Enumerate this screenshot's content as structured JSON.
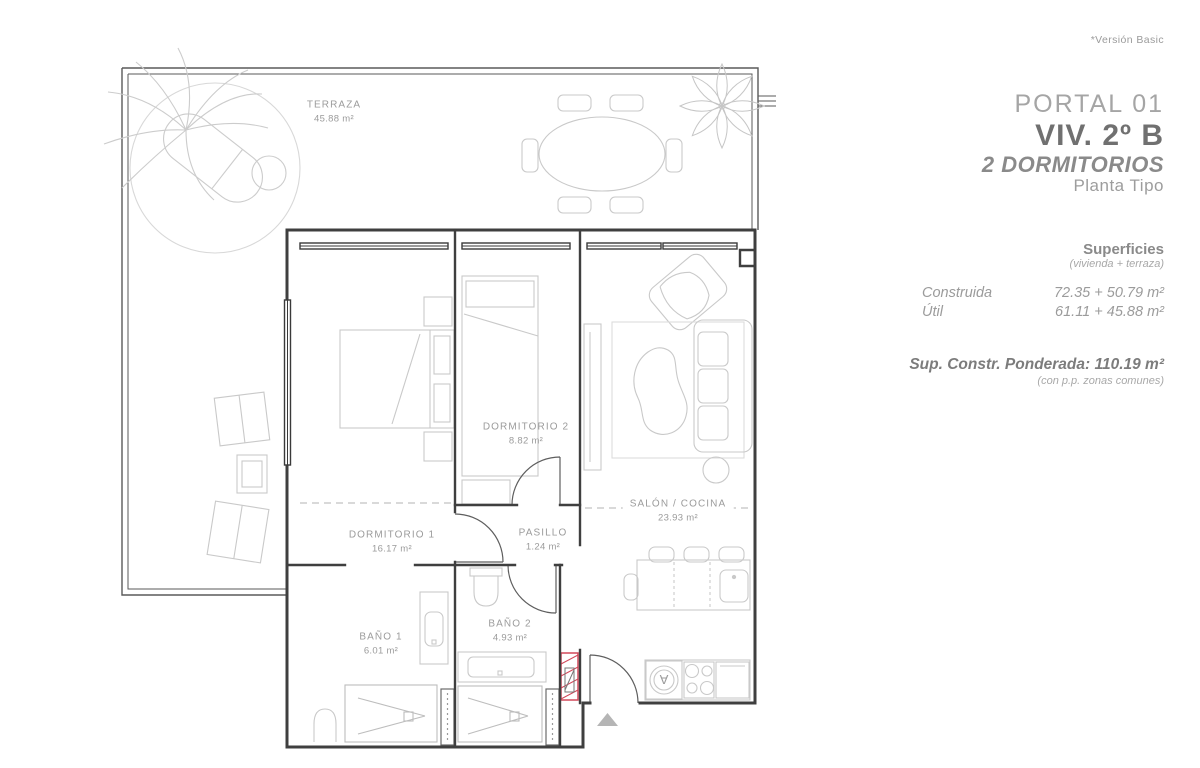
{
  "version_note": "*Versión Basic",
  "header": {
    "portal": "PORTAL 01",
    "unit": "VIV. 2º B",
    "bedrooms": "2 DORMITORIOS",
    "plan_type": "Planta Tipo"
  },
  "surfaces": {
    "title": "Superficies",
    "subtitle": "(vivienda + terraza)",
    "rows": [
      {
        "label": "Construida",
        "value": "72.35 + 50.79 m²"
      },
      {
        "label": "Útil",
        "value": "61.11 + 45.88 m²"
      }
    ],
    "weighted": "Sup. Constr. Ponderada: 110.19 m²",
    "weighted_note": "(con p.p. zonas comunes)"
  },
  "rooms": [
    {
      "name": "TERRAZA",
      "area": "45.88 m²"
    },
    {
      "name": "DORMITORIO 1",
      "area": "16.17 m²"
    },
    {
      "name": "DORMITORIO 2",
      "area": "8.82 m²"
    },
    {
      "name": "PASILLO",
      "area": "1.24 m²"
    },
    {
      "name": "SALÓN / COCINA",
      "area": "23.93 m²"
    },
    {
      "name": "BAÑO 1",
      "area": "6.01 m²"
    },
    {
      "name": "BAÑO 2",
      "area": "4.93 m²"
    }
  ],
  "plan": {
    "washer_label": "A"
  },
  "colors": {
    "wall": "#3f3f3f",
    "furniture": "#c9c9c9",
    "label_text": "#9b9b9b",
    "accent_red": "#d2485a"
  }
}
